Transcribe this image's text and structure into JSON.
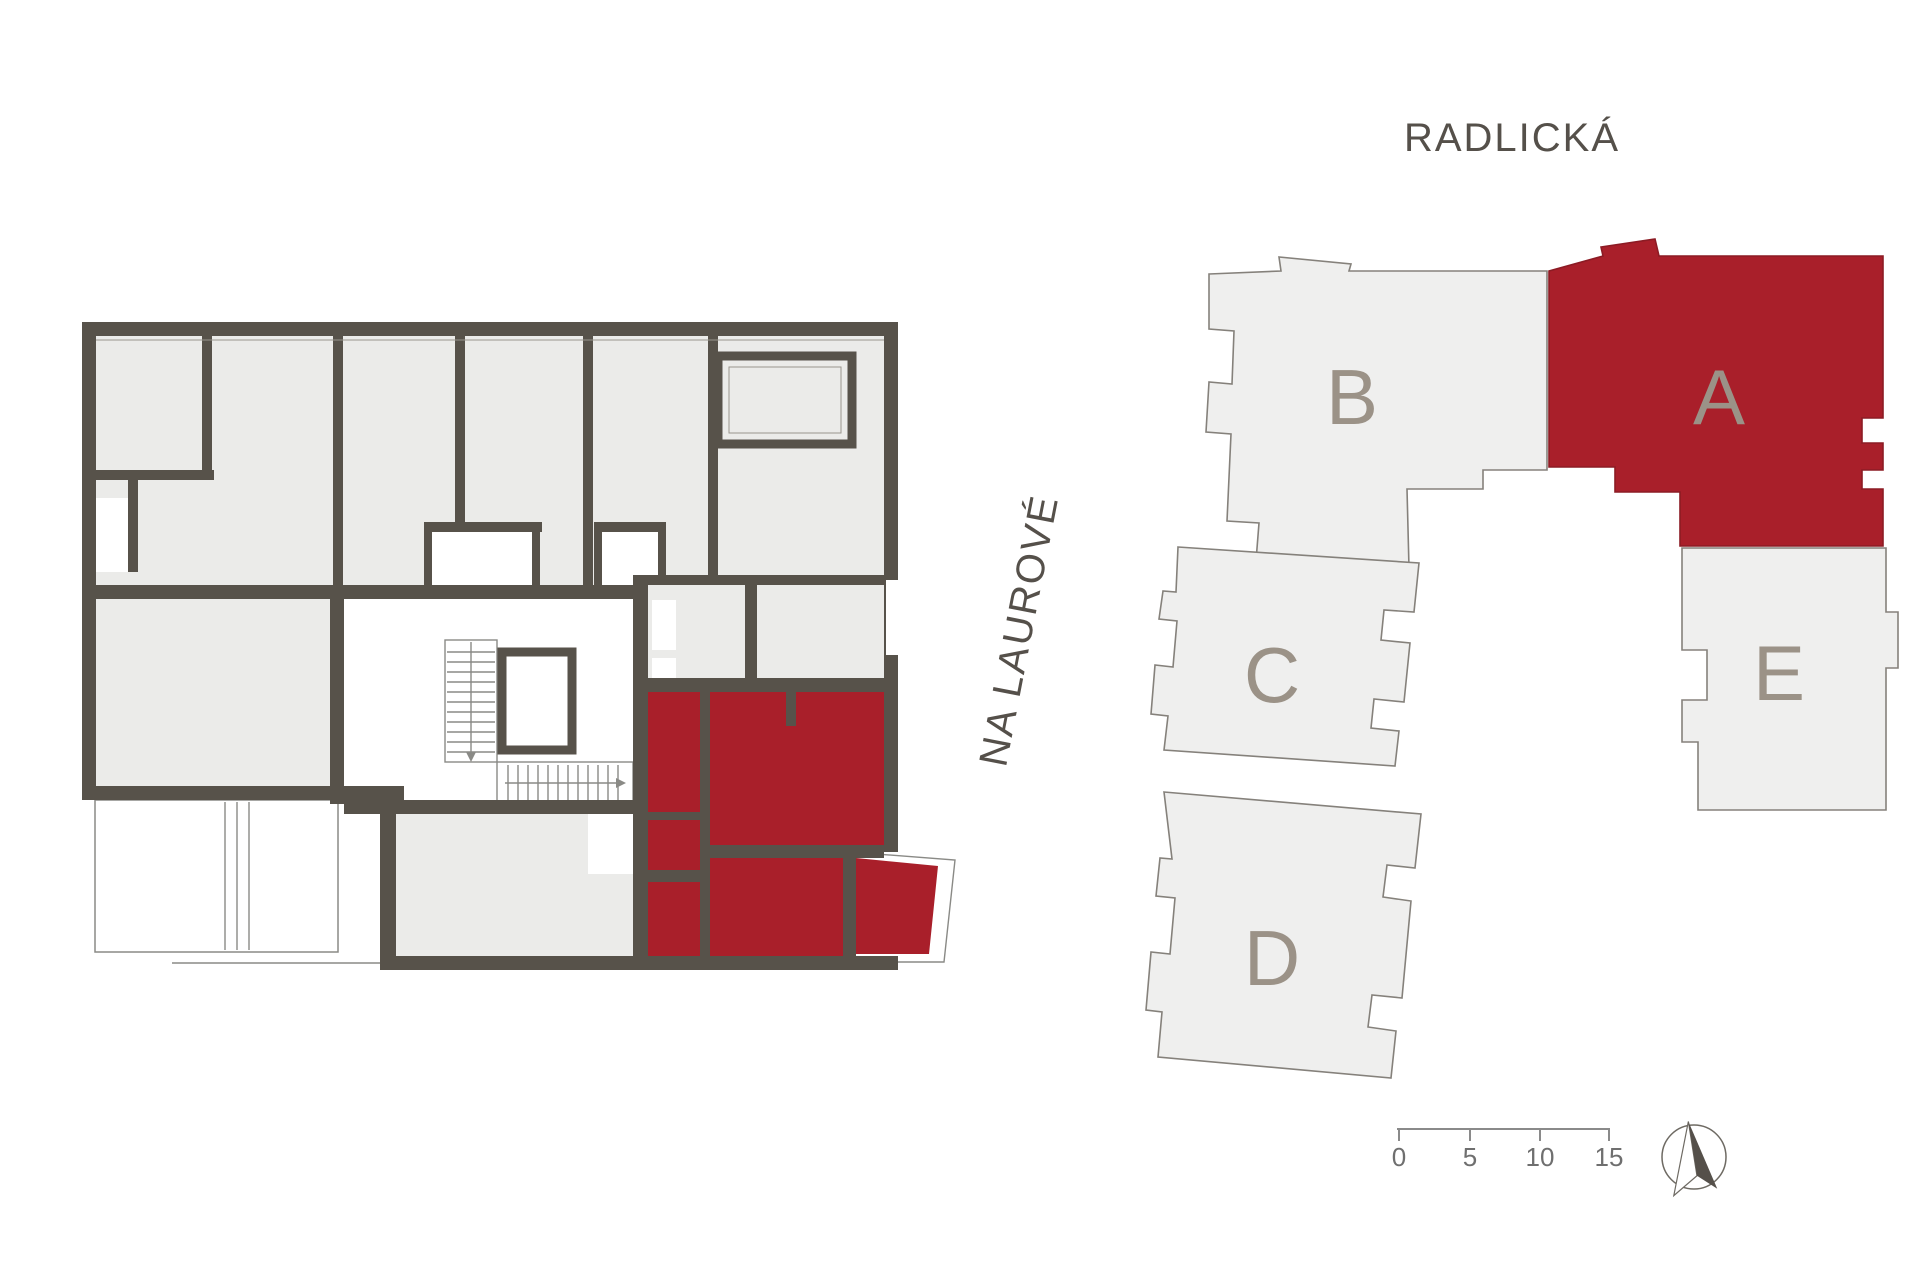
{
  "page": {
    "background": "#ffffff"
  },
  "streets": {
    "top_label": "RADLICKÁ",
    "side_label": "NA LAUROVÉ"
  },
  "site_plan": {
    "blocks": [
      {
        "label": "A",
        "highlighted": true
      },
      {
        "label": "B",
        "highlighted": false
      },
      {
        "label": "C",
        "highlighted": false
      },
      {
        "label": "D",
        "highlighted": false
      },
      {
        "label": "E",
        "highlighted": false
      }
    ],
    "block_fill": "#efefee",
    "block_stroke": "#85817b",
    "highlight_fill": "#a91f2a",
    "label_color": "#9b9287"
  },
  "floor_plan": {
    "wall_color": "#57524a",
    "room_fill": "#ebebe9",
    "highlight_fill": "#a91f2a"
  },
  "scale_bar": {
    "ticks": [
      "0",
      "5",
      "10",
      "15"
    ],
    "color": "#8a8a8a"
  },
  "compass": {
    "icon": "north-arrow"
  },
  "text_color": "#55504a"
}
